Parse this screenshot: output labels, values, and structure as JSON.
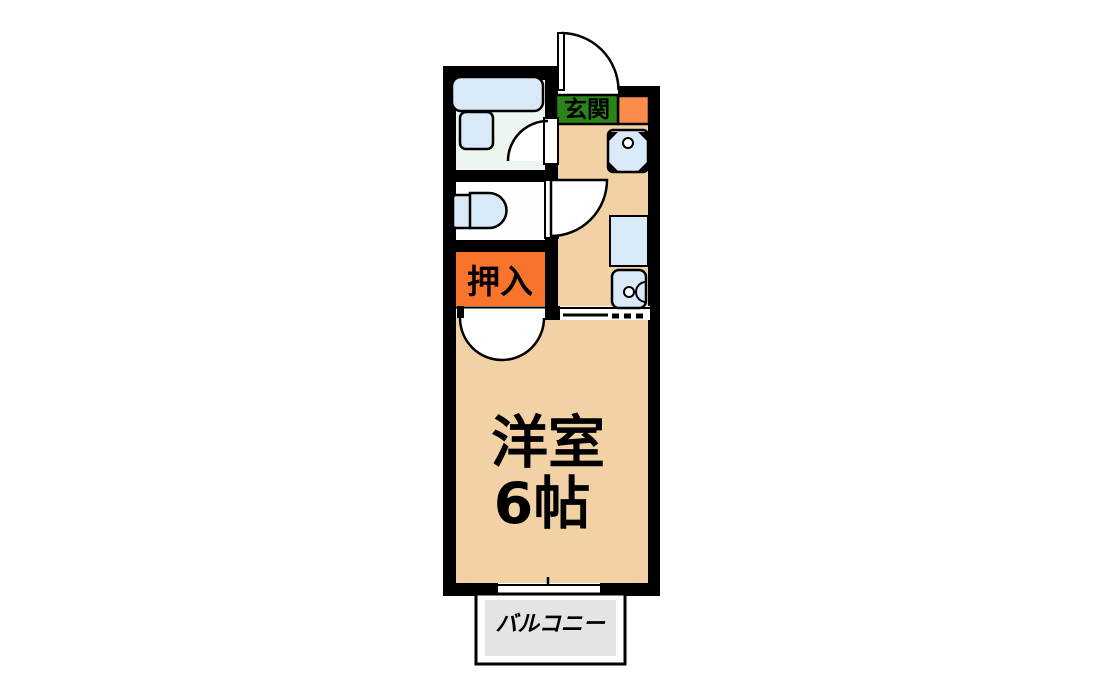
{
  "labels": {
    "entrance": "玄関",
    "closet": "押入",
    "room_name": "洋室",
    "room_size": "6帖",
    "balcony": "バルコニー"
  },
  "colors": {
    "wall": "#000000",
    "floor": "#f2d2a4",
    "bathroom_floor": "#ecf6ef",
    "toilet_floor": "#fdfefd",
    "fixture": "#d9e9f7",
    "closet": "#f8742c",
    "entrance_step": "#fb8c4c",
    "entrance_sign_bg": "#2b841a",
    "balcony": "#e4e4e4",
    "door_leaf": "#ffffff"
  }
}
